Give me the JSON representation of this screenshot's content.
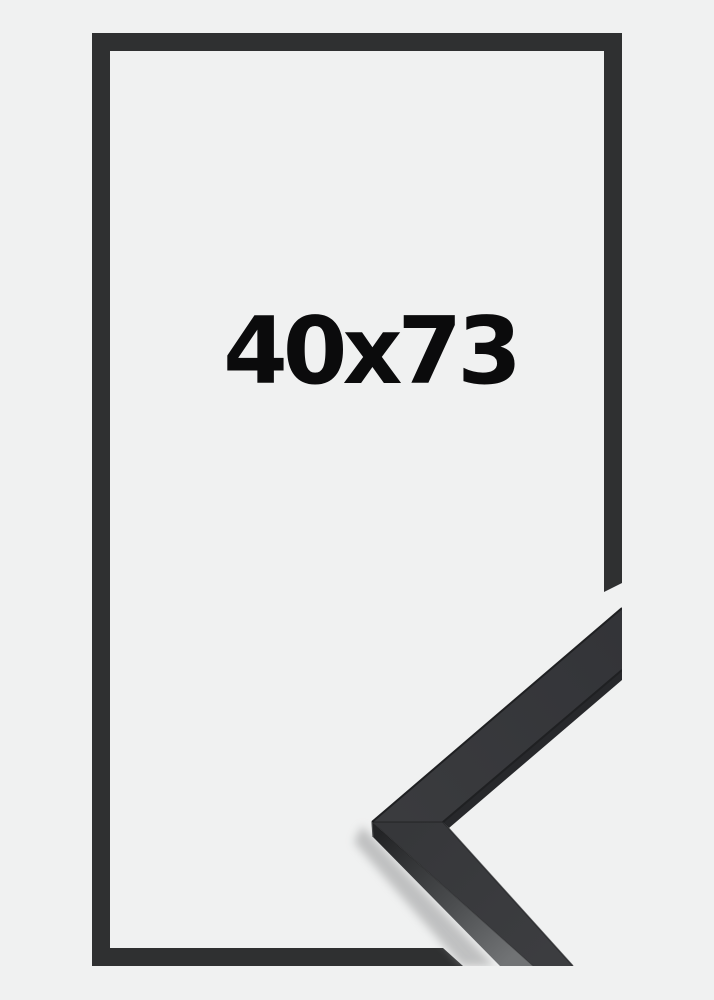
{
  "page": {
    "background_color": "#f0f1f1"
  },
  "frame_preview": {
    "size_label": "40x73",
    "label_color": "#0b0b0c",
    "outline_color": "#2f3031",
    "sample": {
      "top_arm_face_start": "#3a3b3e",
      "top_arm_face_end": "#333438",
      "bottom_arm_face_start": "#36373a",
      "bottom_arm_face_end": "#3c3d40",
      "side_dark": "#232426",
      "side_mid": "#4a4c4e",
      "side_light": "#717375",
      "edge_color": "#1f2022",
      "underside_color": "#27282b",
      "seam_color": "rgba(0,0,0,0.28)",
      "corner_highlight": "#4a4b4d",
      "shadow_color": "#8f9091"
    }
  }
}
